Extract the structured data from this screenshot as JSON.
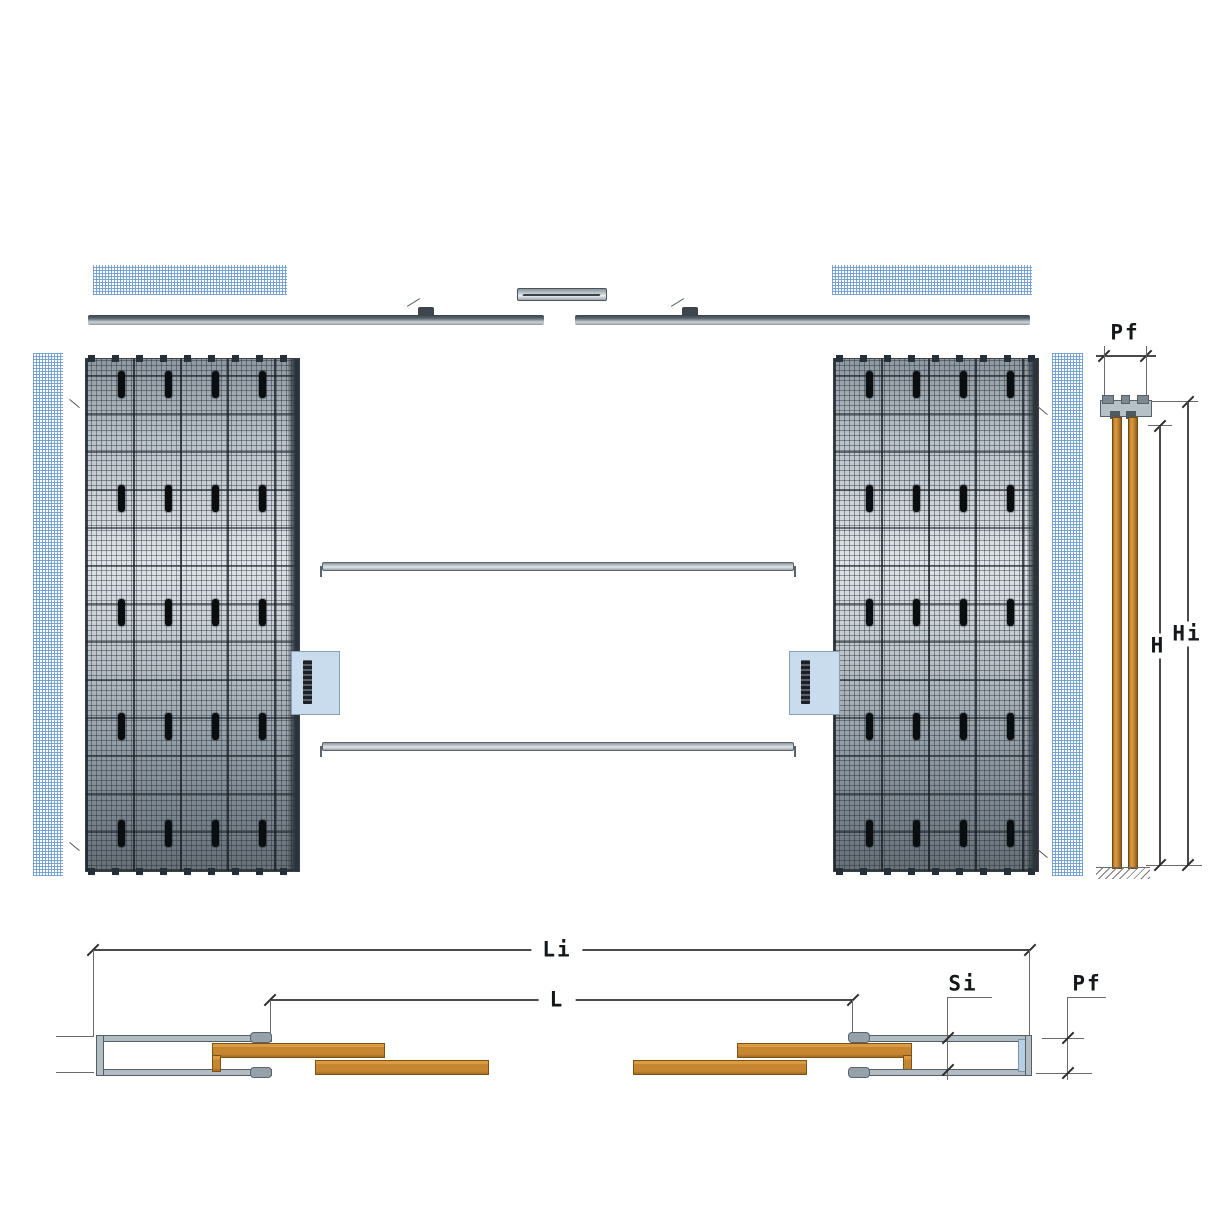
{
  "labels": {
    "section": {
      "pf": "Pf",
      "h": "H",
      "hi": "Hi"
    },
    "plan": {
      "li": "Li",
      "l": "L",
      "si": "Si",
      "pf": "Pf"
    }
  },
  "colors": {
    "wood": "#c68631",
    "steel": "#aeb8bf",
    "mesh_blue": "#6f9ed0",
    "dimension": "#4a4a4a",
    "sticker": "#c9dcee",
    "panel_dark": "#2b333b"
  }
}
